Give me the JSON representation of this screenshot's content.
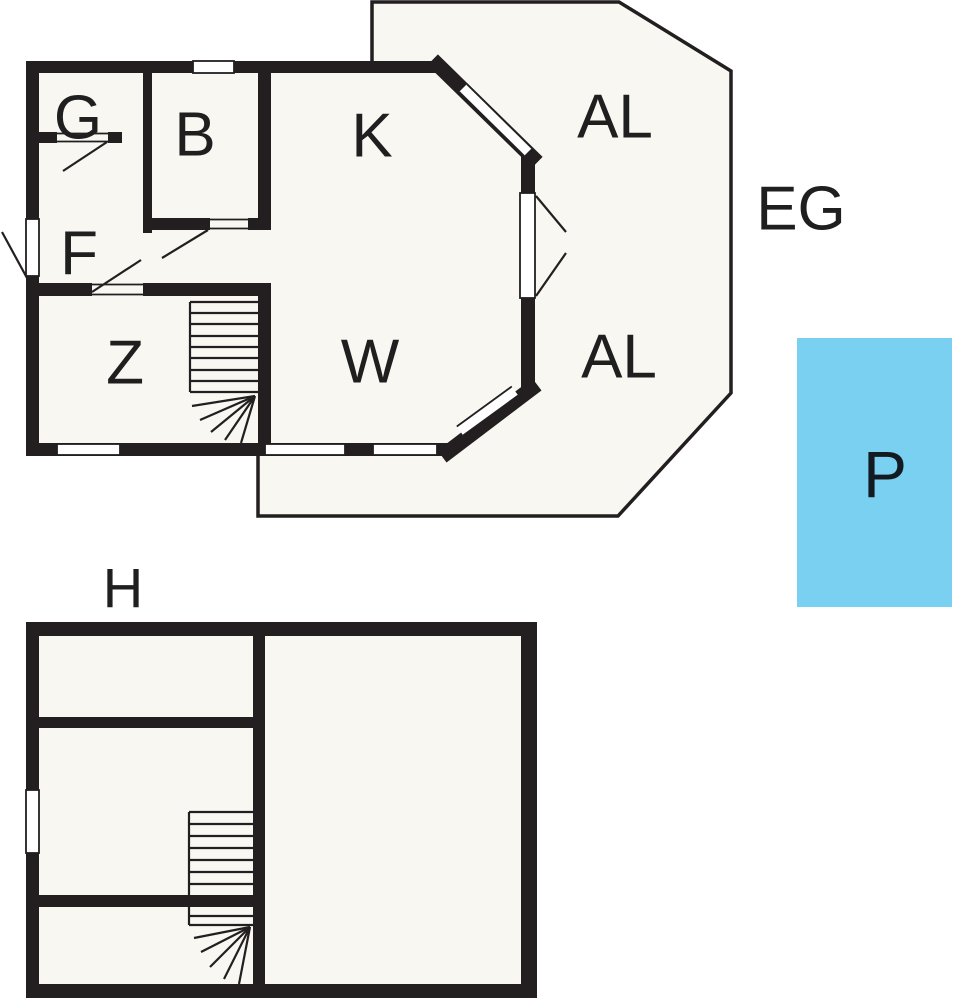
{
  "colors": {
    "wall": "#231f20",
    "floor": "#f8f7f2",
    "pool_fill": "#7ad0f0",
    "pool_text": "#141a22",
    "background": "#ffffff"
  },
  "upper_floor": {
    "label": "EG",
    "rooms": {
      "g": "G",
      "b": "B",
      "k": "K",
      "f": "F",
      "z": "Z",
      "w": "W"
    },
    "terrace_upper": "AL",
    "terrace_lower": "AL"
  },
  "lower_floor": {
    "label": "H"
  },
  "pool": {
    "label": "P"
  }
}
